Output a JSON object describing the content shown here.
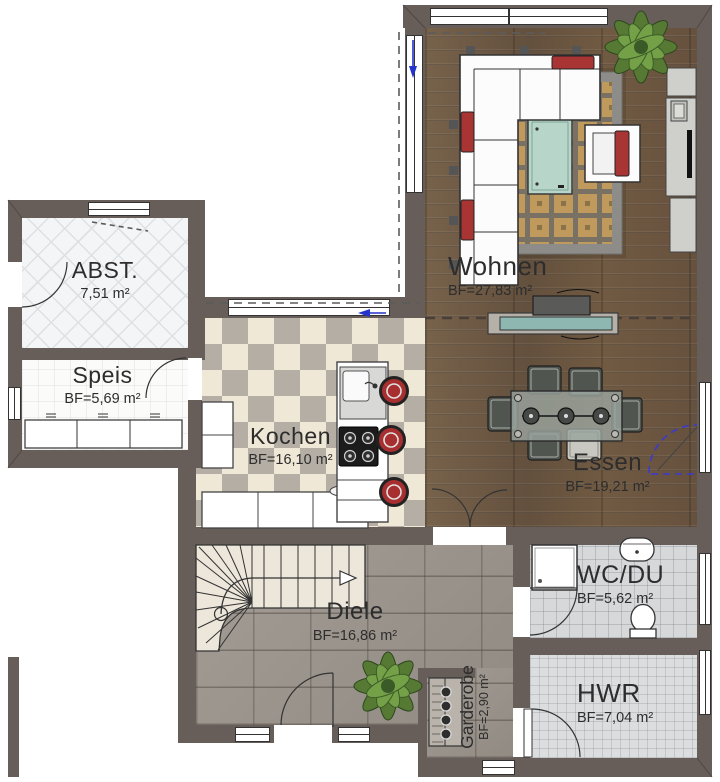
{
  "plan": {
    "rooms": [
      {
        "id": "abst",
        "name": "ABST.",
        "area": "7,51 m²"
      },
      {
        "id": "speis",
        "name": "Speis",
        "area": "BF=5,69 m²"
      },
      {
        "id": "kochen",
        "name": "Kochen",
        "area": "BF=16,10 m²"
      },
      {
        "id": "wohnen",
        "name": "Wohnen",
        "area": "BF=27,83 m²"
      },
      {
        "id": "essen",
        "name": "Essen",
        "area": "BF=19,21 m²"
      },
      {
        "id": "diele",
        "name": "Diele",
        "area": "BF=16,86 m²"
      },
      {
        "id": "wcdu",
        "name": "WC/DU",
        "area": "BF=5,62 m²"
      },
      {
        "id": "hwr",
        "name": "HWR",
        "area": "BF=7,04 m²"
      },
      {
        "id": "garderobe",
        "name": "Garderobe",
        "area": "BF=2,90 m²"
      }
    ],
    "colors": {
      "wall": "#675d59",
      "wood_floor": "#6f5944",
      "checker_light": "#efe8d7",
      "checker_dark": "#b5aea4",
      "diele_tile": "#9c958d",
      "accent_red": "#a83434",
      "section_blue": "#2333cc",
      "coffee_table": "#b7d6c9"
    }
  }
}
